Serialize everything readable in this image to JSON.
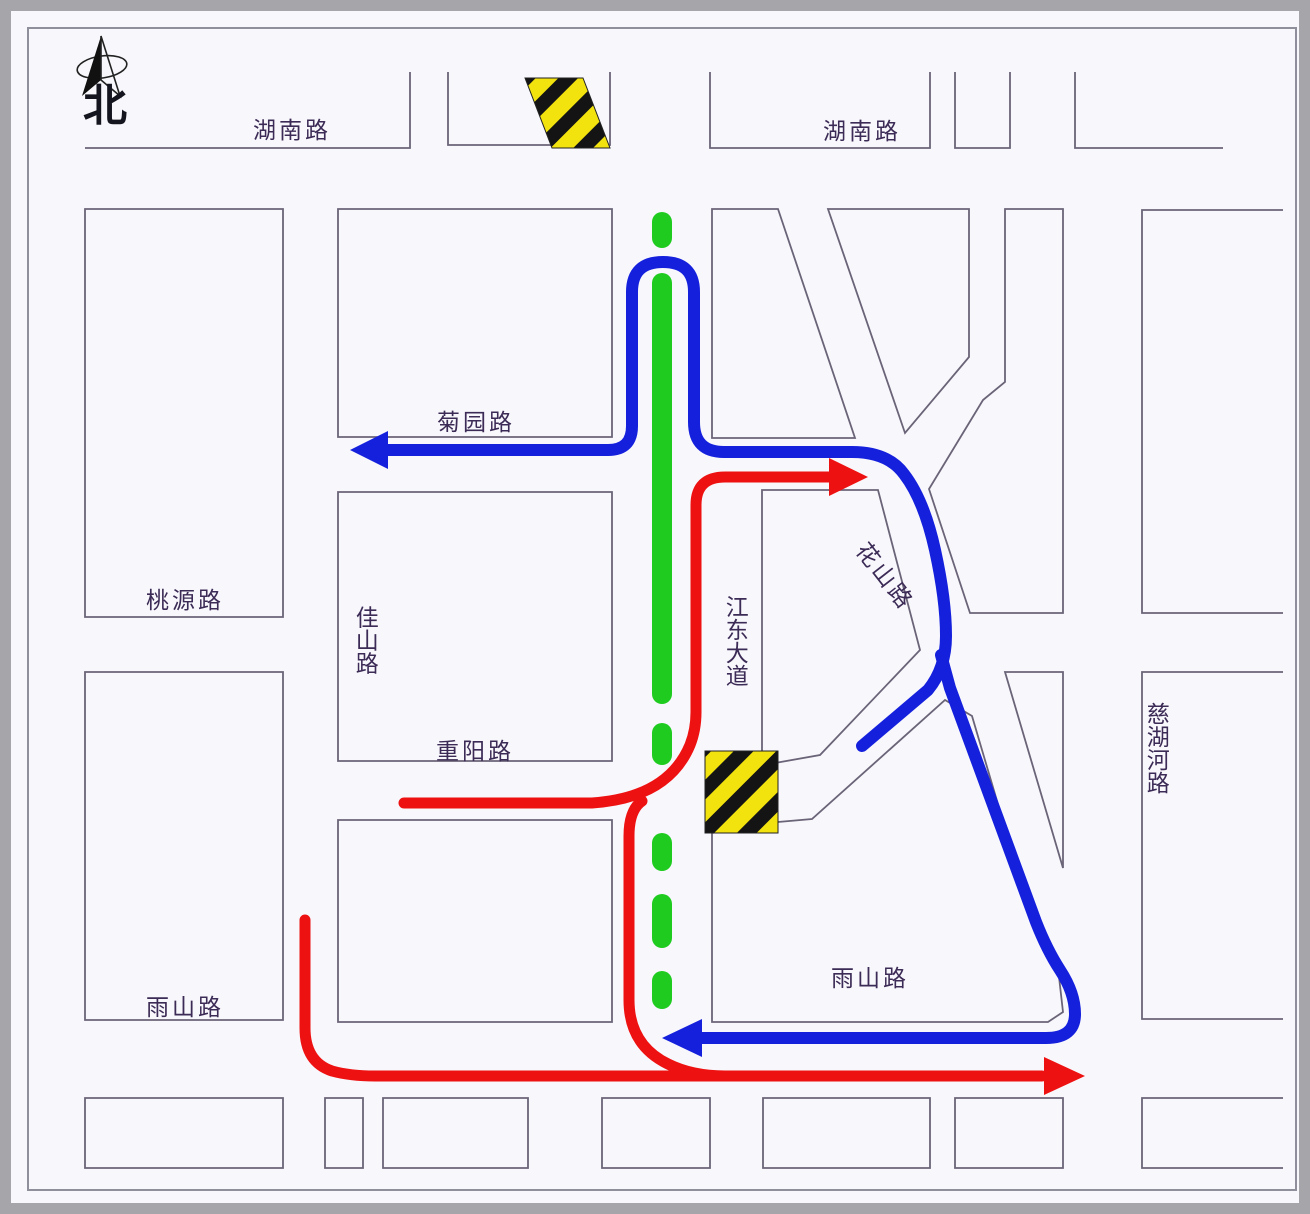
{
  "compass": {
    "label": "北"
  },
  "roads": [
    {
      "id": "hunan-west",
      "name": "湖南路"
    },
    {
      "id": "hunan-east",
      "name": "湖南路"
    },
    {
      "id": "juyuan",
      "name": "菊园路"
    },
    {
      "id": "taoyuan",
      "name": "桃源路"
    },
    {
      "id": "jiashan",
      "name": "佳山路"
    },
    {
      "id": "jiangdong-avenue",
      "name": "江东大道"
    },
    {
      "id": "huashan",
      "name": "花山路"
    },
    {
      "id": "chongyang",
      "name": "重阳路"
    },
    {
      "id": "cihuhe",
      "name": "慈湖河路"
    },
    {
      "id": "yushan-west",
      "name": "雨山路"
    },
    {
      "id": "yushan-east",
      "name": "雨山路"
    }
  ],
  "legend_colors": {
    "detour_route_blue": "#1520dd",
    "detour_route_red": "#ee1111",
    "closed_section_green": "#1ecb1e",
    "hazard_yellow": "#f2e30e",
    "hazard_black": "#141414",
    "road_line": "#6b6478",
    "label_text": "#3c2b56"
  }
}
